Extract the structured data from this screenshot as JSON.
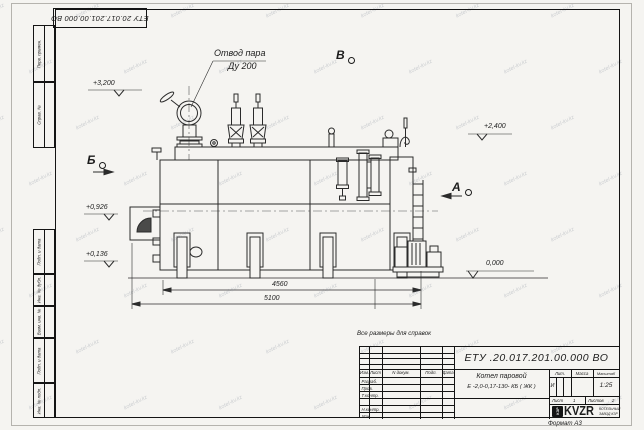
{
  "frame": {
    "top_doc_number": "ЕТУ 20.017.201.00.000  ВО",
    "side_fields_top": [
      {
        "label": "Перв. примен."
      },
      {
        "label": "Справ. №"
      }
    ],
    "side_fields_bottom": [
      {
        "label": "Подп. и дата"
      },
      {
        "label": "Инв. № дубл."
      },
      {
        "label": "Взам. инв. №"
      },
      {
        "label": "Подп. и дата"
      },
      {
        "label": "Инв. № подл."
      }
    ],
    "format_label": "Формат А3"
  },
  "note": "Все размеры для справок",
  "drawing": {
    "callout": {
      "line1": "Отвод пара",
      "line2": "Ду 200"
    },
    "elevations": {
      "top_left": "+3,200",
      "right": "+2,400",
      "mid_left": "+0,926",
      "low_left": "+0,136",
      "ground": "0,000"
    },
    "sections": {
      "a": "А",
      "b": "Б",
      "v": "В"
    },
    "dims": {
      "inner": "4560",
      "overall": "5100"
    }
  },
  "title_block": {
    "doc_number": "ЕТУ .20.017.201.00.000  ВО",
    "name_line1": "Котел паровой",
    "name_line2": "Е -2,0-0,17-130- КБ ( ЖК )",
    "cols": {
      "izm": "Изм.",
      "list": "Лист",
      "doc": "N докум.",
      "sign": "Подп.",
      "date": "Дата"
    },
    "rows": [
      {
        "label": "Разраб."
      },
      {
        "label": "Пров."
      },
      {
        "label": "Т.контр."
      },
      {
        "label": ""
      },
      {
        "label": "Н.контр."
      },
      {
        "label": "Утв."
      }
    ],
    "lit": {
      "label": "Лит.",
      "value": "И"
    },
    "mass": {
      "label": "Масса",
      "value": ""
    },
    "scale": {
      "label": "Масштаб",
      "value": "1:25"
    },
    "sheet": {
      "label": "Лист",
      "value": "1"
    },
    "sheets": {
      "label": "Листов",
      "value": "2"
    },
    "logo": {
      "monogram": "КЗР",
      "text": "KVZR",
      "sub1": "КОТЕЛЬНЫЙ",
      "sub2": "ЗАВОД КЗР"
    }
  },
  "watermark": {
    "text": "kotel-kv.kz"
  }
}
